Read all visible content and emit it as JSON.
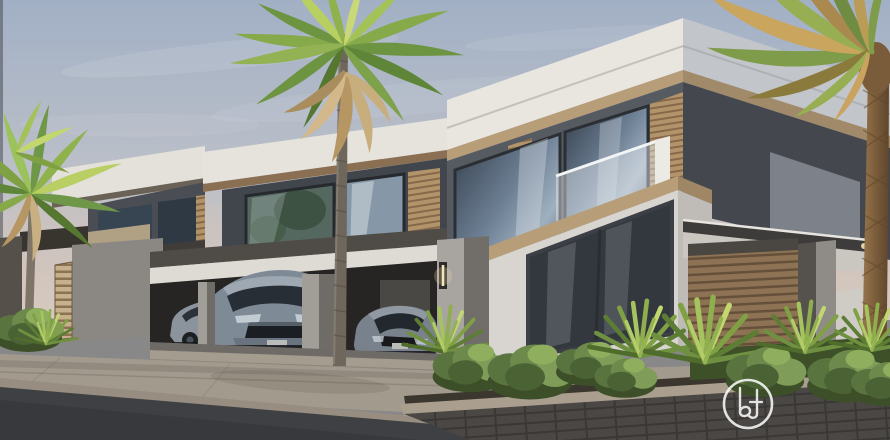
{
  "scene": {
    "type": "architectural-exterior-render",
    "description": "Modern flat-roofed villas with wood-slat accents, glass balconies, a carport with three grey cars, palm trees, landscaped bushes and a street in warm evening light",
    "objects": [
      "sky",
      "villa-left",
      "villa-center",
      "villa-main",
      "carport",
      "car-sedan-left",
      "car-suv",
      "car-sedan-right",
      "palm-left",
      "palm-center",
      "palm-right",
      "bushes",
      "pavement",
      "road",
      "watermark-logo"
    ]
  },
  "colors": {
    "sky_top": "#a2b0c5",
    "sky_horizon": "#d6cabf",
    "parapet_white": "#e9e6e0",
    "wall_dark": "#565b62",
    "wood_trim": "#b79d78",
    "wood_slats": "#a8885f",
    "wall_light": "#d8d5d0",
    "glass_dark": "#33383f",
    "carport_shadow": "#262524",
    "pillar_grey": "#a8a5a0",
    "car_grey": "#7e8a96",
    "foliage_green": "#6f9840",
    "foliage_dry": "#c8ab79",
    "pavement": "#a39a8e",
    "road": "#3f4043",
    "watermark": "#ffffff"
  },
  "watermark": {
    "shape": "circular-outline-monogram",
    "position": "lower-right-center"
  }
}
